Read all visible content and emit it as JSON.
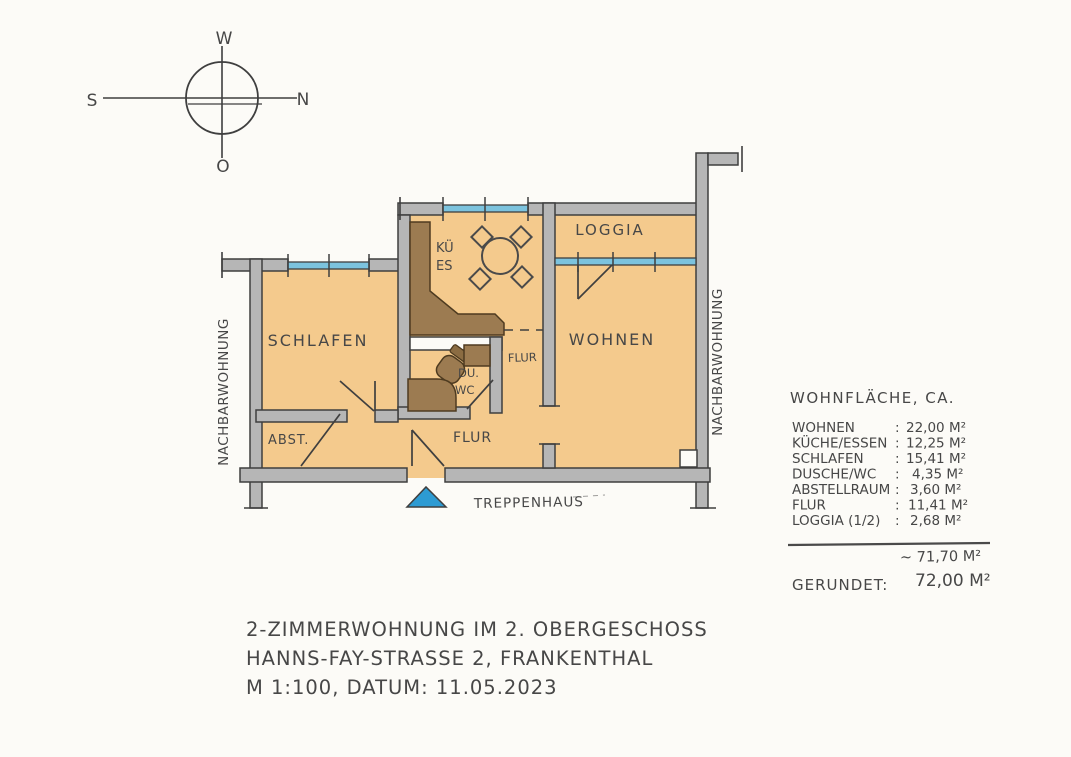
{
  "compass": {
    "top": "W",
    "left": "S",
    "right": "N",
    "bottom": "O"
  },
  "plan": {
    "rooms": {
      "schlafen": "SCHLAFEN",
      "abstellraum": "ABST.",
      "kueche_line1": "KÜ",
      "kueche_line2": "ES",
      "dusche_line1": "DU.",
      "dusche_line2": "WC",
      "flur_upper": "FLUR",
      "flur_lower": "FLUR",
      "wohnen": "WOHNEN",
      "loggia": "LOGGIA"
    },
    "annotations": {
      "treppenhaus": "TREPPENHAUS",
      "nachbar_left": "NACHBARWOHNUNG",
      "nachbar_right": "NACHBARWOHNUNG"
    }
  },
  "area_table": {
    "header": "WOHNFLÄCHE, CA.",
    "colon": ":",
    "rows": [
      {
        "label": "WOHNEN",
        "value": "22,00 M²"
      },
      {
        "label": "KÜCHE/ESSEN",
        "value": "12,25 M²"
      },
      {
        "label": "SCHLAFEN",
        "value": "15,41 M²"
      },
      {
        "label": "DUSCHE/WC",
        "value": "4,35 M²"
      },
      {
        "label": "ABSTELLRAUM",
        "value": "3,60 M²"
      },
      {
        "label": "FLUR",
        "value": "11,41 M²"
      },
      {
        "label": "LOGGIA (1/2)",
        "value": "2,68 M²"
      }
    ],
    "subtotal": "~ 71,70 M²",
    "rounded_label": "GERUNDET:",
    "rounded_value": "72,00 M²"
  },
  "footer": {
    "line1": "2-ZIMMERWOHNUNG IM 2. OBERGESCHOSS",
    "line2": "HANNS-FAY-STRASSE 2, FRANKENTHAL",
    "line3": "M 1:100, DATUM: 11.05.2023"
  },
  "colors": {
    "floor": "#f4ca8d",
    "wall": "#b6b6b6",
    "window_glass": "#7cc3de",
    "furniture": "#9c7b51",
    "entry_marker": "#2d9bd3",
    "pencil": "#4a4a4a"
  }
}
